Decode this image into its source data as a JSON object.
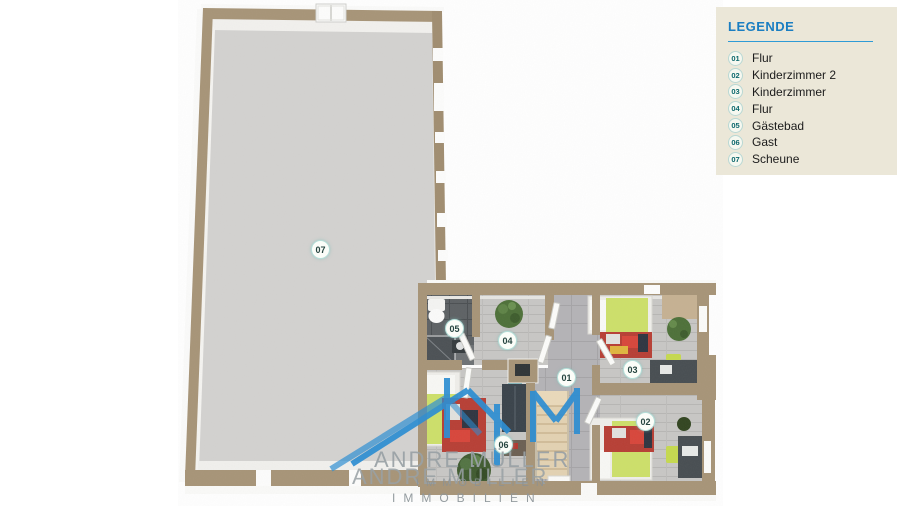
{
  "legend": {
    "title": "LEGENDE",
    "items": [
      {
        "id": "01",
        "label": "Flur"
      },
      {
        "id": "02",
        "label": "Kinderzimmer 2"
      },
      {
        "id": "03",
        "label": "Kinderzimmer"
      },
      {
        "id": "04",
        "label": "Flur"
      },
      {
        "id": "05",
        "label": "Gästebad"
      },
      {
        "id": "06",
        "label": "Gast"
      },
      {
        "id": "07",
        "label": "Scheune"
      }
    ],
    "colors": {
      "panel_bg": "#ebe7d8",
      "title": "#1a7ec2",
      "rule": "#2e9bd6",
      "badge_text": "#0c686d",
      "item_text": "#1c1c1c"
    }
  },
  "plan": {
    "badges": [
      {
        "id": "07"
      },
      {
        "id": "05"
      },
      {
        "id": "04"
      },
      {
        "id": "01"
      },
      {
        "id": "03"
      },
      {
        "id": "02"
      },
      {
        "id": "06"
      }
    ],
    "colors": {
      "wall": "#a79477",
      "floor_concrete": "#d3d2d0",
      "floor_wood": "#c8c7c5",
      "floor_stone": "#b4b3b6",
      "floor_bath": "#5d6164",
      "bed": "#cde069",
      "rug": "#b73e34",
      "furniture_dark": "#474d51",
      "plant": "#4d7038",
      "stairs": "#e3d2b2"
    }
  },
  "watermark": {
    "line1": "ANDRE MÜLLER",
    "line2": "ANDRE MÜLLER",
    "line3": "IMMOBILIEN",
    "line4": "IMMOBILIEN",
    "logo_color": "#2e8ed2",
    "text_color": "#99a1a5"
  }
}
